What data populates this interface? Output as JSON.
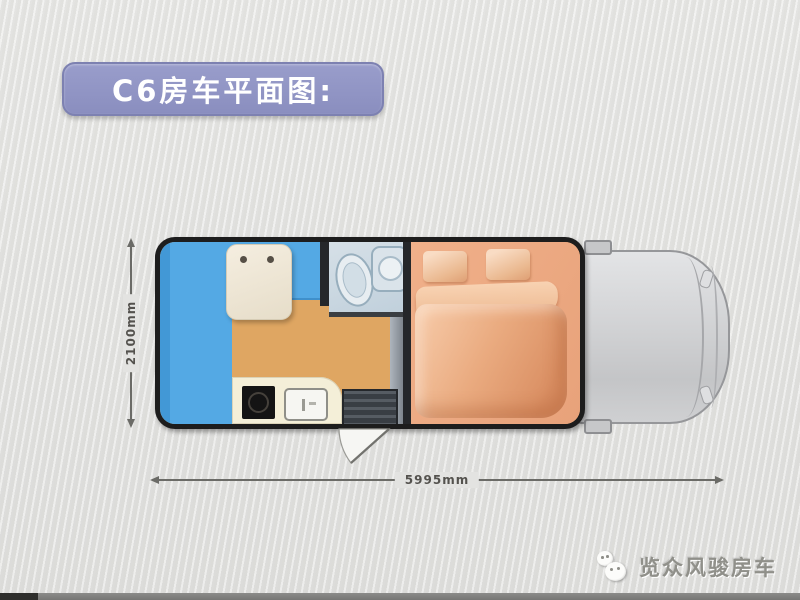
{
  "title": {
    "text": "C6房车平面图:",
    "background_color": "#8e92c4",
    "text_color": "#ffffff"
  },
  "dimensions": {
    "height_label": "2100mm",
    "width_label": "5995mm"
  },
  "watermark": {
    "icon": "wechat-icon",
    "text": "览众风骏房车"
  },
  "plan": {
    "type": "floorplan",
    "subject": "C6 motorhome top-view layout with truck cab",
    "colors": {
      "background": "#e3e3e1",
      "body_outline": "#1d1d1d",
      "sofa_blue": "#54a9e4",
      "floor_tan": "#dfa662",
      "table_cream": "#efe8d8",
      "bathroom_blue_gray": "#c9d7e1",
      "counter_cream": "#f4efd8",
      "stove_black": "#141414",
      "steps_gray": "#44484d",
      "bed_peach": "#eca77e",
      "cab_gray": "#d5d6d8",
      "title_purple": "#8e92c4"
    },
    "rooms": [
      {
        "name": "side-sofa",
        "color": "#54a9e4"
      },
      {
        "name": "front-bench-seat",
        "color": "#54a9e4"
      },
      {
        "name": "dinette-table",
        "color": "#efe8d8"
      },
      {
        "name": "bathroom",
        "color": "#c9d7e1"
      },
      {
        "name": "toilet",
        "color": "#e7edf1"
      },
      {
        "name": "wash-basin",
        "color": "#dae3ea"
      },
      {
        "name": "kitchen-counter",
        "color": "#f4efd8"
      },
      {
        "name": "stove",
        "color": "#141414"
      },
      {
        "name": "kitchen-sink",
        "color": "#f6f6f2"
      },
      {
        "name": "entry-steps",
        "color": "#44484d"
      },
      {
        "name": "entry-door-swing",
        "color": "#f6f6f3"
      },
      {
        "name": "wardrobe-partition",
        "color": "#9aa1a9"
      },
      {
        "name": "double-bed",
        "color": "#eca77e"
      },
      {
        "name": "pillows",
        "color": "#f2c49e"
      },
      {
        "name": "truck-cab",
        "color": "#d5d6d8"
      }
    ]
  }
}
